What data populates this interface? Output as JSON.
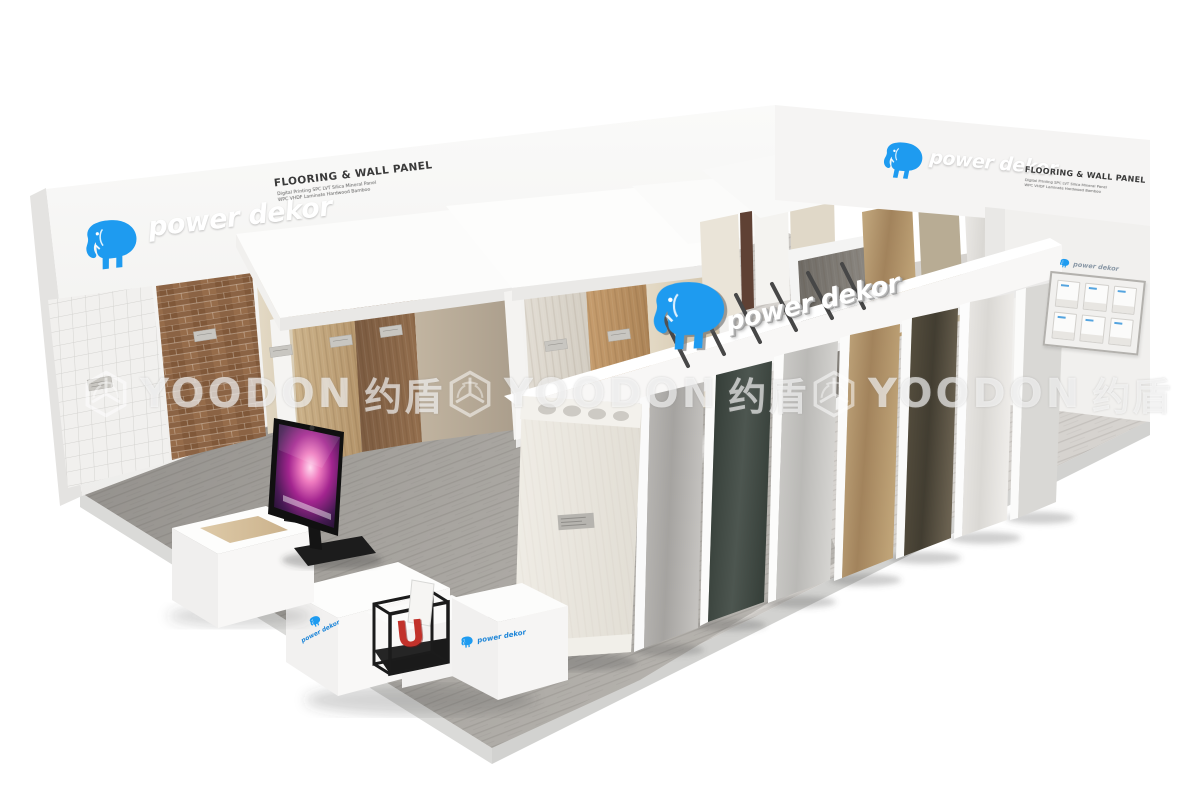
{
  "scene": {
    "description": "3D rendering of a power dekor flooring and wall panel exhibition booth, isometric view on white background",
    "watermark_repeats": 3
  },
  "brand": {
    "name": "power dekor",
    "tagline": "FLOORING & WALL PANEL",
    "subtitle_line1": "Digital Printing SPC LVT Silica Mineral Panel",
    "subtitle_line2": "WPC VHDF Laminate Hardwood Bamboo",
    "blue": "#1e9bf0"
  },
  "watermark": {
    "latin": "YOODON",
    "cjk": "约盾"
  },
  "partition_sign": {
    "text": "power dekor"
  },
  "reception_desk": {
    "logo_left": "power dekor",
    "logo_right": "power dekor",
    "cube_letter": "U",
    "cube_letter_color": "#c2322b"
  },
  "brochure_rack": {
    "logo": "power dekor",
    "pockets": 6
  },
  "tv": {
    "wallpaper": "galaxy"
  },
  "palette": {
    "background": "#ffffff",
    "wall_white": "#f6f5f4",
    "floor_gray": "#9a9793",
    "floor_light": "#d3d0cc",
    "wood_brown": "#8b6344",
    "wood_oak": "#c49a6a",
    "stone_dark": "#3d4640",
    "marble_white": "#e9e8e5"
  }
}
